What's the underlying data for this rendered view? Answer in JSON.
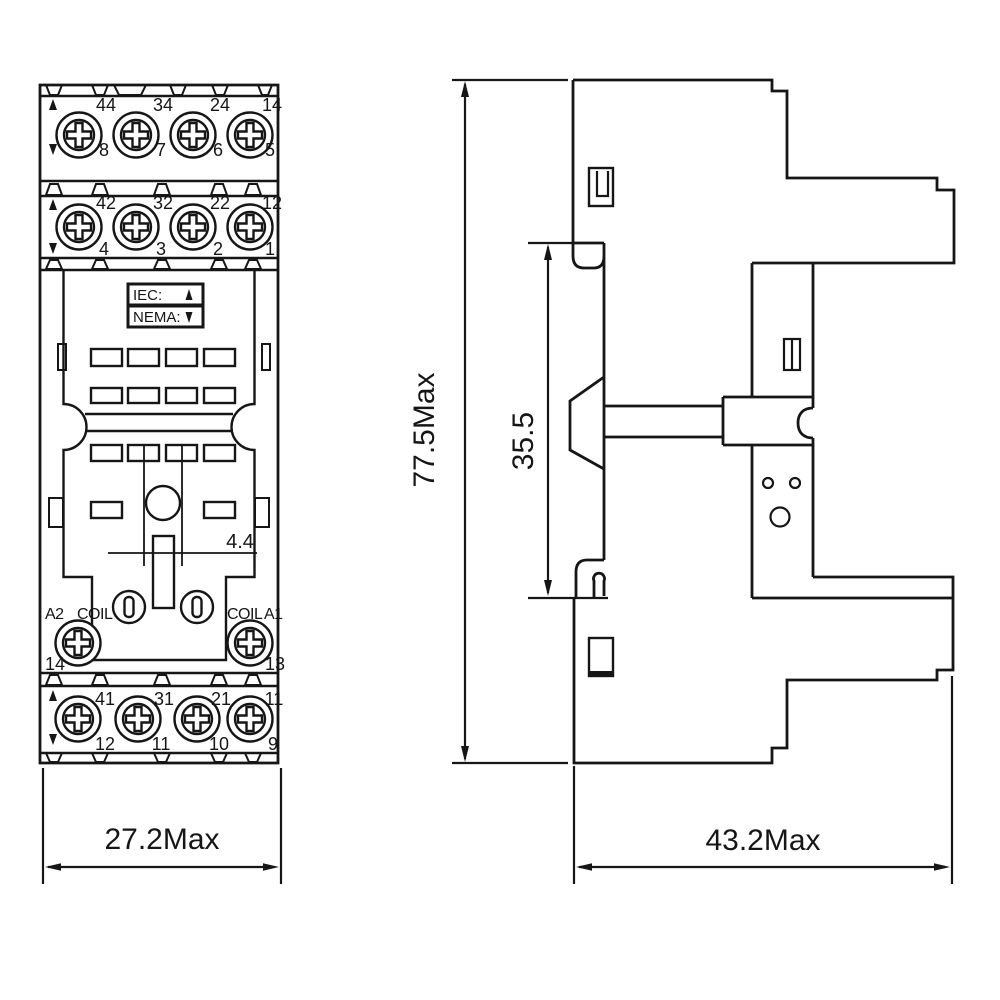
{
  "front_view": {
    "row1_top": [
      "44",
      "34",
      "24",
      "14"
    ],
    "row1_bottom": [
      "8",
      "7",
      "6",
      "5"
    ],
    "row2_top": [
      "42",
      "32",
      "22",
      "12"
    ],
    "row2_bottom": [
      "4",
      "3",
      "2",
      "1"
    ],
    "standards_box": {
      "iec": "IEC:",
      "nema": "NEMA:"
    },
    "coil": {
      "a2": "A2",
      "coil_left": "COIL",
      "coil_right": "COIL",
      "a1": "A1",
      "terminal_left": "14",
      "terminal_right": "13"
    },
    "row3_top": [
      "41",
      "31",
      "21",
      "11"
    ],
    "row3_bottom": [
      "12",
      "11",
      "10",
      "9"
    ],
    "slot_dim": "4.4",
    "width_dim": "27.2Max"
  },
  "side_view": {
    "height_dim": "77.5Max",
    "rail_dim": "35.5",
    "depth_dim": "43.2Max"
  },
  "colors": {
    "line": "#161616",
    "background": "#ffffff"
  }
}
